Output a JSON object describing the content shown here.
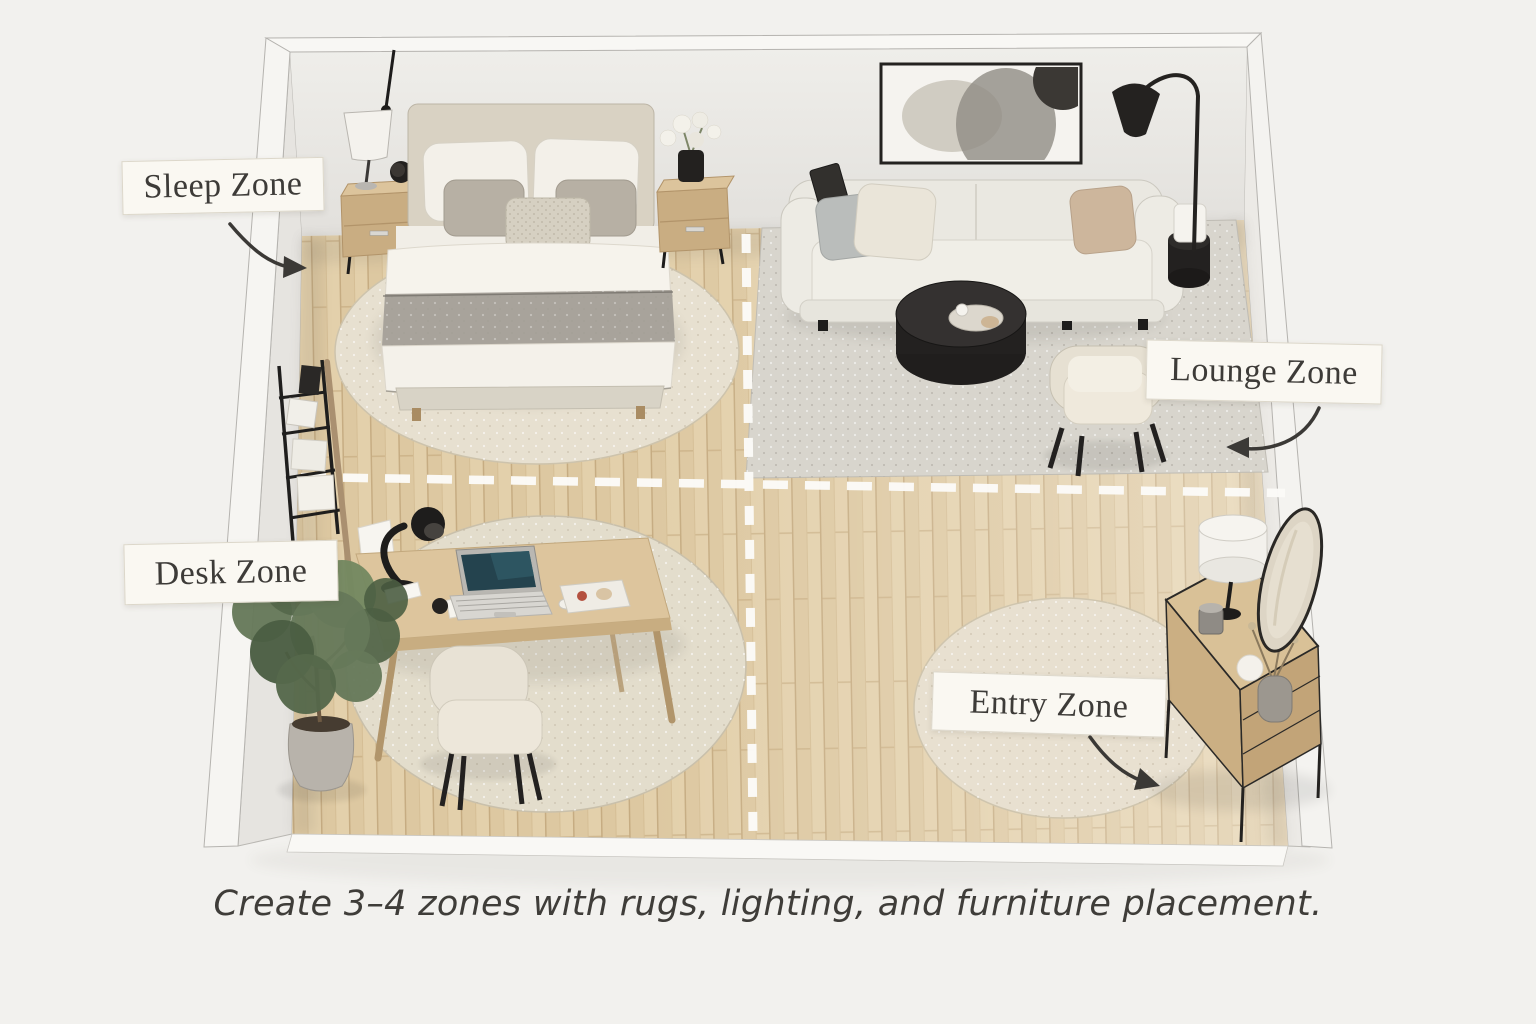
{
  "labels": {
    "sleep": "Sleep Zone",
    "lounge": "Lounge Zone",
    "desk": "Desk Zone",
    "entry": "Entry Zone"
  },
  "caption": "Create 3–4 zones with rugs, lighting, and furniture placement.",
  "palette": {
    "background": "#f2f1ee",
    "wall_face": "#e8e6e2",
    "wall_rim": "#f7f6f3",
    "floor_wood": "#e3d0ab",
    "rug_beige": "#e7e0d0",
    "rug_grey": "#d8d5cd",
    "furniture_wood": "#d5bc93",
    "accent_black": "#232120",
    "divider_dash": "#fcfbf8",
    "label_bg": "#faf8f2",
    "label_border": "#dcd7ca",
    "label_text": "#3d3b38",
    "arrow": "#3b3936"
  },
  "objects": {
    "sleep_zone": [
      "bed",
      "headboard",
      "pillows",
      "blanket-runner",
      "round-rug",
      "nightstand-left",
      "nightstand-right",
      "floor-lamp",
      "alarm-clock",
      "flower-vase"
    ],
    "lounge_zone": [
      "sofa",
      "throw-pillows",
      "tablet",
      "wall-art",
      "arc-floor-lamp",
      "side-table",
      "cube-lamp",
      "coffee-table",
      "tray",
      "armchair",
      "area-rug"
    ],
    "desk_zone": [
      "desk",
      "desk-lamp",
      "laptop",
      "papers",
      "speaker",
      "notebook",
      "mouse",
      "desk-chair",
      "round-rug",
      "potted-plant",
      "bookshelf",
      "leaning-pole"
    ],
    "entry_zone": [
      "round-rug",
      "console-table",
      "drum-lamp",
      "candle",
      "jug",
      "vase-with-twigs",
      "wall-mirror"
    ]
  }
}
